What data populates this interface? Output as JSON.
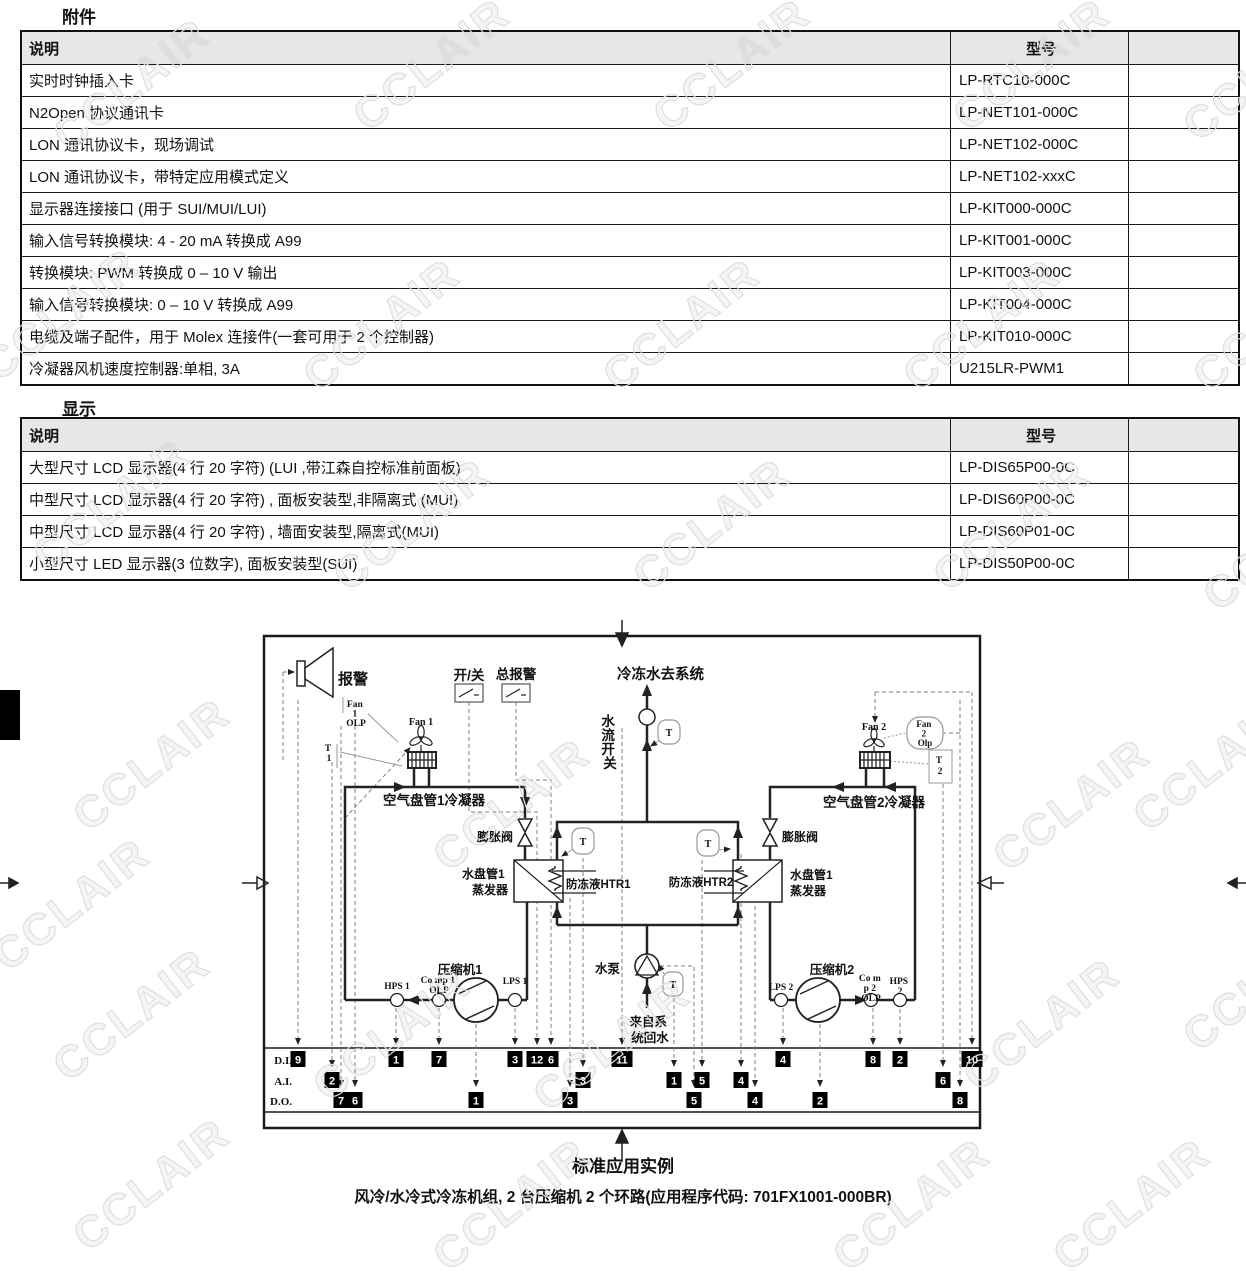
{
  "page": {
    "watermark": "CCLAIR"
  },
  "sections": {
    "attachments": {
      "title": "附件",
      "table": {
        "headers": [
          "说明",
          "型号",
          ""
        ],
        "rows": [
          [
            "实时时钟插入卡",
            "LP-RTC10-000C"
          ],
          [
            "N2Open 协议通讯卡",
            "LP-NET101-000C"
          ],
          [
            "LON 通讯协议卡，现场调试",
            "LP-NET102-000C"
          ],
          [
            "LON 通讯协议卡，带特定应用模式定义",
            "LP-NET102-xxxC"
          ],
          [
            "显示器连接接口 (用于 SUI/MUI/LUI)",
            "LP-KIT000-000C"
          ],
          [
            "输入信号转换模块: 4 - 20 mA 转换成 A99",
            "LP-KIT001-000C"
          ],
          [
            "转换模块: PWM 转换成 0 – 10 V 输出",
            "LP-KIT003-000C"
          ],
          [
            "输入信号转换模块: 0 – 10 V 转换成 A99",
            "LP-KIT004-000C"
          ],
          [
            "电缆及端子配件，用于 Molex 连接件(一套可用于 2 个控制器)",
            "LP-KIT010-000C"
          ],
          [
            "冷凝器风机速度控制器:单相, 3A",
            "U215LR-PWM1"
          ]
        ]
      }
    },
    "displays": {
      "title": "显示",
      "table": {
        "headers": [
          "说明",
          "型号",
          ""
        ],
        "rows": [
          [
            "大型尺寸 LCD 显示器(4 行 20 字符) (LUI ,带江森自控标准前面板)",
            "LP-DIS65P00-0C"
          ],
          [
            "中型尺寸 LCD 显示器(4 行 20 字符) , 面板安装型,非隔离式 (MUI)",
            "LP-DIS60P00-0C"
          ],
          [
            "中型尺寸 LCD 显示器(4 行 20 字符) , 墙面安装型,隔离式(MUI)",
            "LP-DIS60P01-0C"
          ],
          [
            "小型尺寸 LED 显示器(3 位数字), 面板安装型(SUI)",
            "LP-DIS50P00-0C"
          ]
        ]
      }
    }
  },
  "diagram": {
    "labels": {
      "alarm": "报警",
      "fan1_olp": [
        "Fan",
        "1",
        "OLP"
      ],
      "t1": [
        "T",
        "1"
      ],
      "fan1": "Fan 1",
      "on_off": "开/关",
      "general_alarm": "总报警",
      "chilled_water_out": "冷冻水去系统",
      "water_flow_switch": [
        "水",
        "流",
        "开",
        "关"
      ],
      "condenser1": "空气盘管1冷凝器",
      "condenser2": "空气盘管2冷凝器",
      "fan2": "Fan 2",
      "fan2_olp": [
        "Fan",
        "2",
        "Olp"
      ],
      "t2": [
        "T",
        "2"
      ],
      "exp_valve1": "膨胀阀",
      "exp_valve2": "膨胀阀",
      "evap1": [
        "水盘管1",
        "蒸发器"
      ],
      "evap2": [
        "水盘管1",
        "蒸发器"
      ],
      "htr1": "防冻液HTR1",
      "htr2": "防冻液HTR2",
      "t_sensor": "T",
      "compressor1": "压缩机1",
      "compressor2": "压缩机2",
      "hps1": "HPS 1",
      "comp1_olp": [
        "Co mp 1",
        "OLP"
      ],
      "lps1": "LPS 1",
      "lps2": "LPS 2",
      "comp2_olp": [
        "Co m",
        "p 2",
        "OLP"
      ],
      "hps2": [
        "HPS",
        "2"
      ],
      "pump": "水泵",
      "return_water": [
        "来自系",
        "统回水"
      ],
      "row_di": "D.I.",
      "row_ai": "A.I.",
      "row_do": "D.O."
    },
    "terminals": {
      "di": [
        {
          "n": "9",
          "x": 298
        },
        {
          "n": "1",
          "x": 396
        },
        {
          "n": "7",
          "x": 439
        },
        {
          "n": "3",
          "x": 515
        },
        {
          "n": "12",
          "x": 537
        },
        {
          "n": "6",
          "x": 551
        },
        {
          "n": "11",
          "x": 622
        },
        {
          "n": "4",
          "x": 783
        },
        {
          "n": "8",
          "x": 873
        },
        {
          "n": "2",
          "x": 900
        },
        {
          "n": "10",
          "x": 972
        }
      ],
      "ai": [
        {
          "n": "2",
          "x": 332
        },
        {
          "n": "3",
          "x": 583
        },
        {
          "n": "1",
          "x": 674
        },
        {
          "n": "5",
          "x": 702
        },
        {
          "n": "4",
          "x": 741
        },
        {
          "n": "6",
          "x": 943
        }
      ],
      "do": [
        {
          "n": "7",
          "x": 341
        },
        {
          "n": "6",
          "x": 355
        },
        {
          "n": "1",
          "x": 476
        },
        {
          "n": "3",
          "x": 570
        },
        {
          "n": "5",
          "x": 694
        },
        {
          "n": "4",
          "x": 755
        },
        {
          "n": "2",
          "x": 820
        },
        {
          "n": "8",
          "x": 960
        }
      ]
    },
    "caption": {
      "line1": "标准应用实例",
      "line2": "风冷/水冷式冷冻机组, 2 台压缩机 2 个环路(应用程序代码: 701FX1001-000BR)"
    }
  }
}
